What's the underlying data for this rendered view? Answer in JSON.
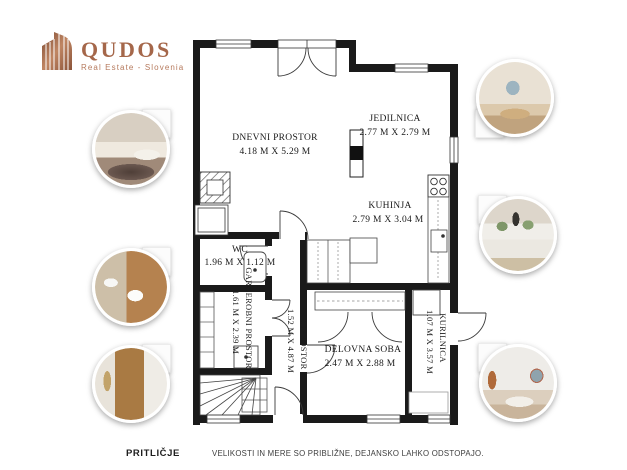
{
  "logo": {
    "name": "QUDOS",
    "subtitle": "Real Estate - Slovenia",
    "icon": "building-icon",
    "brand_color": "#a5674a"
  },
  "floor_plan": {
    "wall_color": "#1a1a1a",
    "rooms": [
      {
        "id": "dnevni-prostor",
        "name": "DNEVNI PROSTOR",
        "dims": "4.18 M X 5.29 M",
        "orientation": "horizontal"
      },
      {
        "id": "jedilnica",
        "name": "JEDILNICA",
        "dims": "2.77 M X 2.79 M",
        "orientation": "horizontal"
      },
      {
        "id": "kuhinja",
        "name": "KUHINJA",
        "dims": "2.79 M X 3.04 M",
        "orientation": "horizontal"
      },
      {
        "id": "wc",
        "name": "WC",
        "dims": "1.96 M X 1.12 M",
        "orientation": "horizontal"
      },
      {
        "id": "garderobni-prostor",
        "name": "GARDEROBNI PROSTOR",
        "dims": "1.61 M X 2.39 M",
        "orientation": "vertical"
      },
      {
        "id": "predprostor",
        "name": "PREDPROSTOR",
        "dims": "1.52 M X 4.87 M",
        "orientation": "vertical"
      },
      {
        "id": "delovna-soba",
        "name": "DELOVNA SOBA",
        "dims": "2.47 M X 2.88 M",
        "orientation": "horizontal"
      },
      {
        "id": "kurilnica",
        "name": "KURILNICA",
        "dims": "1.07 M X 3.57 M",
        "orientation": "vertical"
      }
    ],
    "fixtures": [
      "fireplace",
      "chimney",
      "stove",
      "kitchen-counter-sink",
      "wc-sink",
      "wardrobe-shelves",
      "stairs",
      "boiler"
    ]
  },
  "photos": [
    {
      "name": "living-room-photo",
      "side": "left"
    },
    {
      "name": "bathroom-photo",
      "side": "left"
    },
    {
      "name": "hallway-photo",
      "side": "left"
    },
    {
      "name": "dining-room-photo",
      "side": "right"
    },
    {
      "name": "kitchen-photo",
      "side": "right"
    },
    {
      "name": "work-room-photo",
      "side": "right"
    }
  ],
  "footer": {
    "floor_label": "PRITLIČJE",
    "disclaimer": "VELIKOSTI IN MERE SO PRIBLIŽNE, DEJANSKO LAHKO ODSTOPAJO."
  }
}
